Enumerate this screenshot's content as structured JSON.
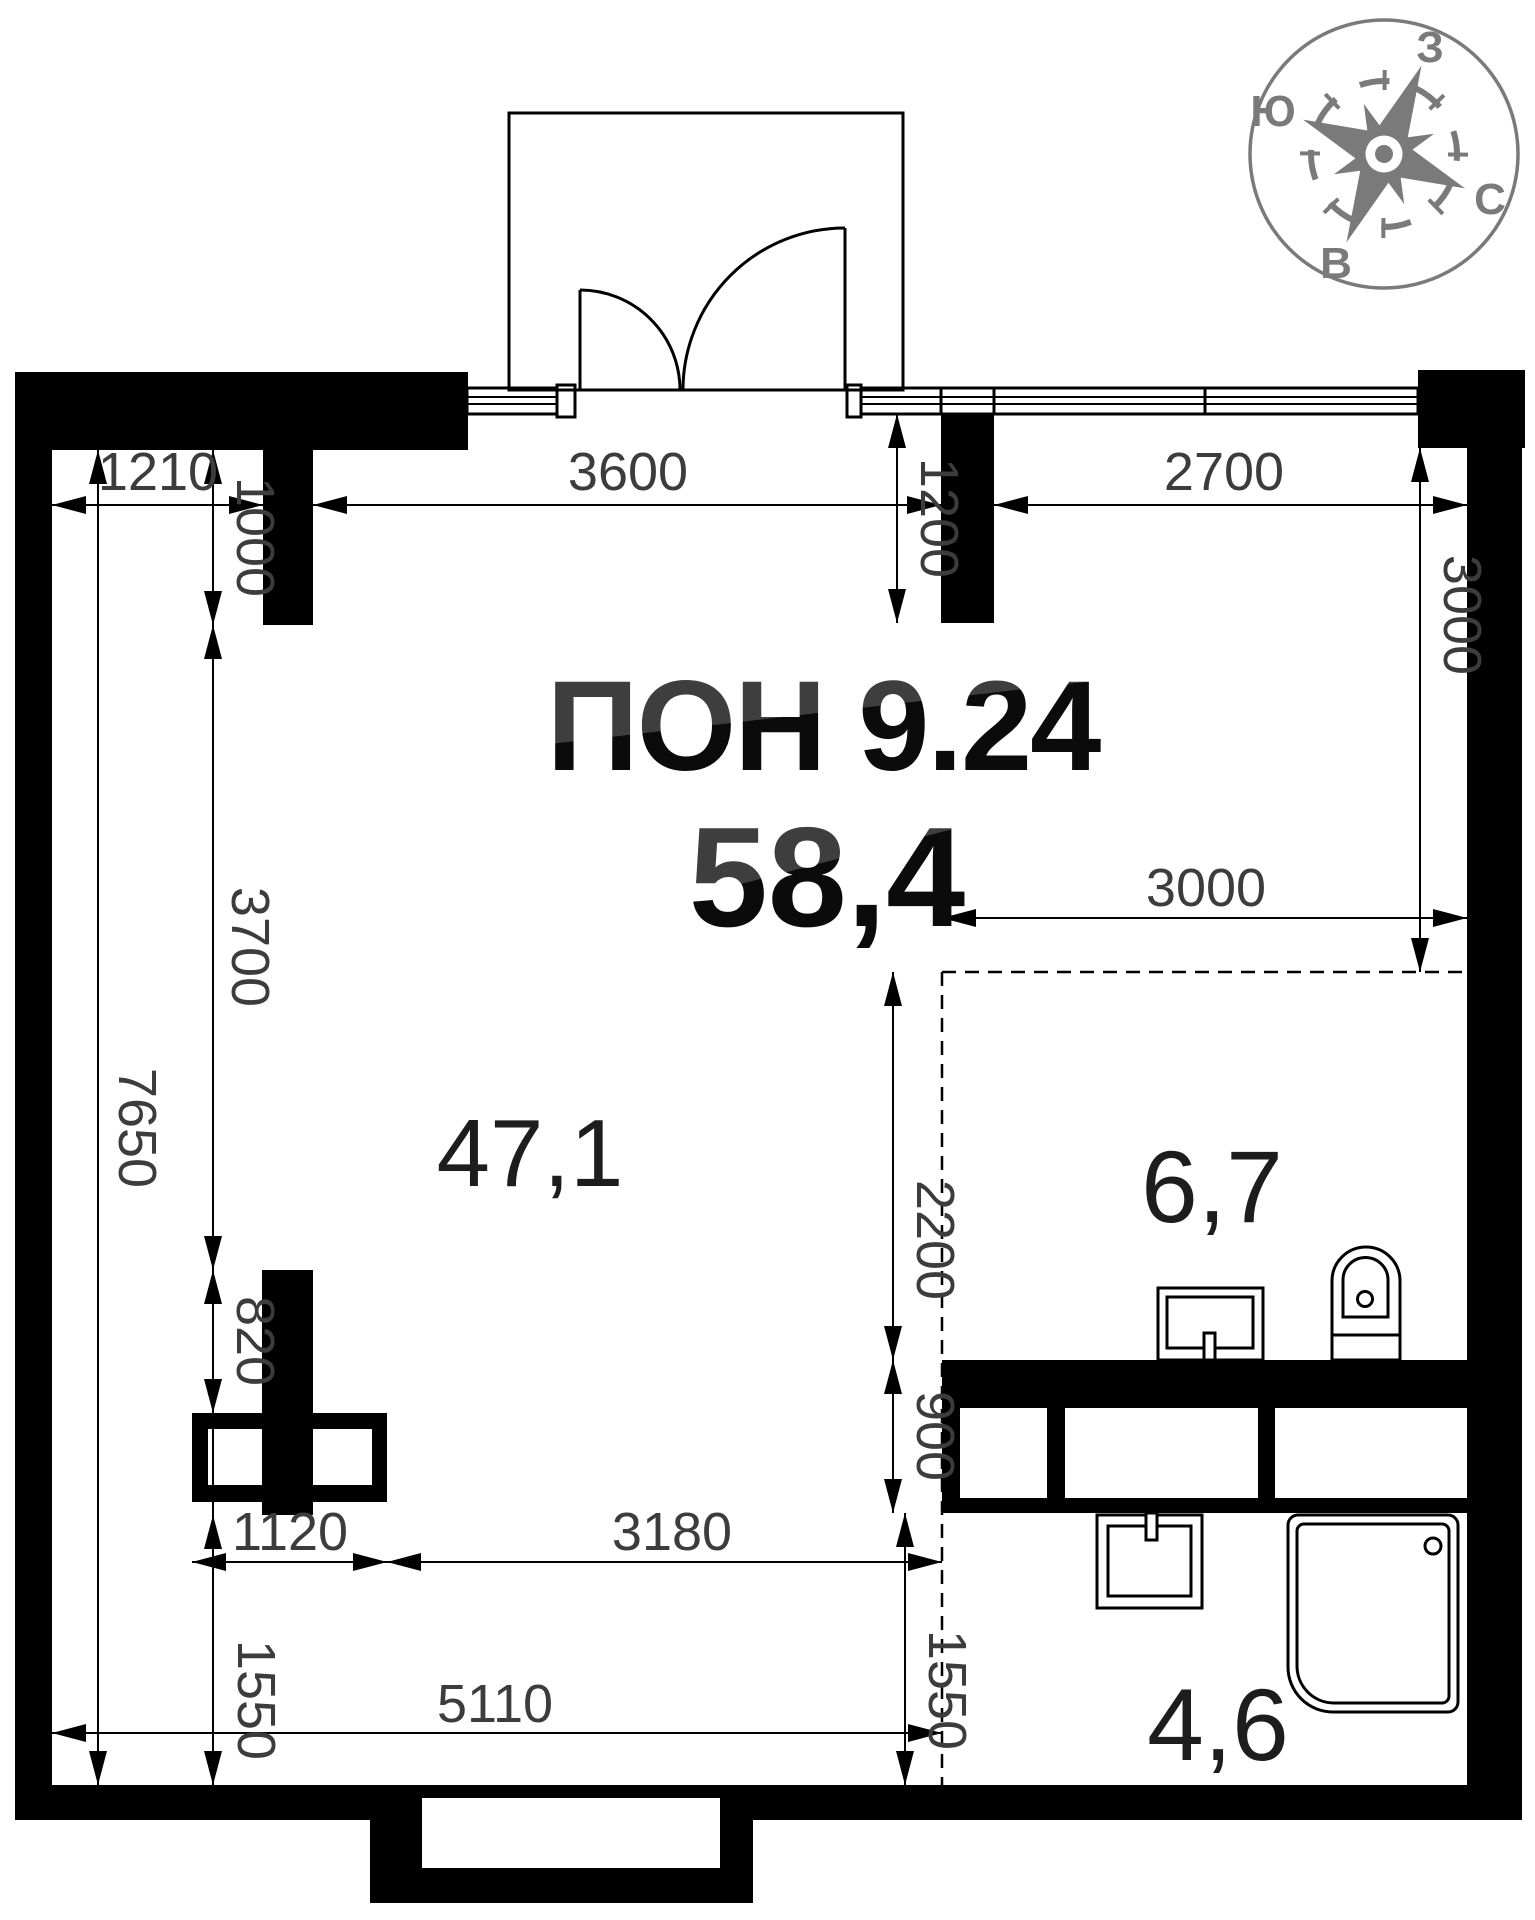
{
  "title": {
    "plan_code": "ПОН 9.24",
    "total_area": "58,4"
  },
  "rooms": {
    "living": {
      "area_label": "47,1"
    },
    "zone_top_right": {
      "area_label": "6,7"
    },
    "bathroom": {
      "area_label": "4,6"
    }
  },
  "dims": {
    "top_left": "1210",
    "top_center": "3600",
    "top_right": "2700",
    "pier_left_height": "1000",
    "pier_right_height": "1200",
    "left_mid": "3700",
    "left_total": "7650",
    "left_lower_pier": "820",
    "left_bottom": "1550",
    "right_zone_width": "3000",
    "right_zone_height": "3000",
    "san_zone_height": "2200",
    "san_zone_lower": "900",
    "shaft_width": "1120",
    "bottom_inner": "3180",
    "bottom_total": "5110",
    "right_bottom": "1550"
  },
  "compass": {
    "top": "З",
    "left": "Ю",
    "right": "С",
    "bottom": "В"
  },
  "colors": {
    "wall": "#000000",
    "dim_text": "#3c3c3c",
    "room_label": "#1d1d1d",
    "title_gray": "#3e3e3e",
    "title_dark": "#0b0b0b",
    "compass": "#7a7a7a",
    "background": "#ffffff"
  }
}
